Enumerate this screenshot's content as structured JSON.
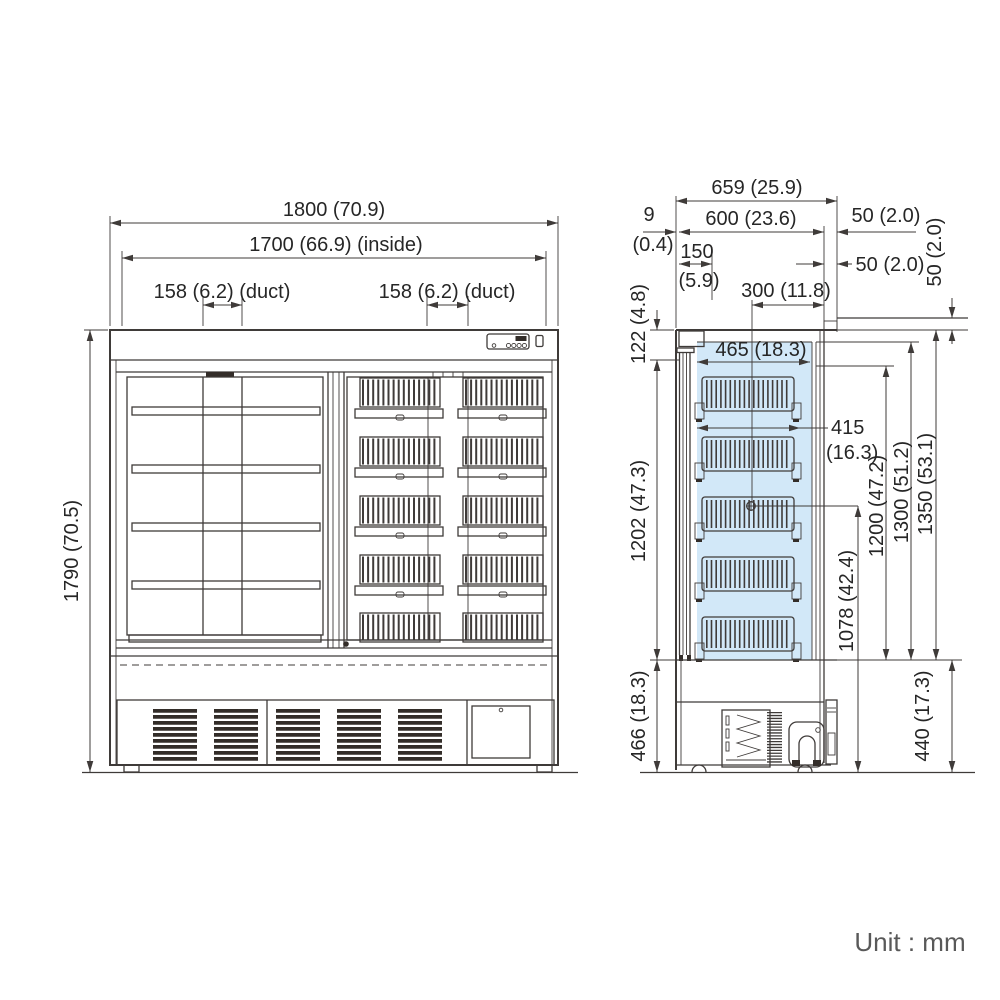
{
  "unit_note": "Unit : mm",
  "front_view": {
    "width_overall": "1800 (70.9)",
    "width_inside": "1700 (66.9) (inside)",
    "duct_left": "158 (6.2) (duct)",
    "duct_right": "158 (6.2) (duct)",
    "height_overall": "1790 (70.5)"
  },
  "side_view": {
    "depth_overall": "659 (25.9)",
    "depth_body": "600 (23.6)",
    "clearance_rear": "50 (2.0)",
    "clearance_rear_duct": "50 (2.0)",
    "clearance_top": "50 (2.0)",
    "front_offset": "9",
    "front_offset_inch": "(0.4)",
    "top_recess": "150",
    "top_recess_inch": "(5.9)",
    "port_from_rear": "300 (11.8)",
    "top_frame_height": "122 (4.8)",
    "shelf_depth": "465 (18.3)",
    "basket_depth": "415",
    "basket_depth_inch": "(16.3)",
    "interior_height": "1202 (47.3)",
    "height_to_shelf_top": "1200 (47.2)",
    "height_glass_top": "1300 (51.2)",
    "height_cabinet_rear": "1350 (53.1)",
    "port_height": "1078 (42.4)",
    "lower_section_height": "466 (18.3)",
    "machine_room_height": "440 (17.3)"
  }
}
